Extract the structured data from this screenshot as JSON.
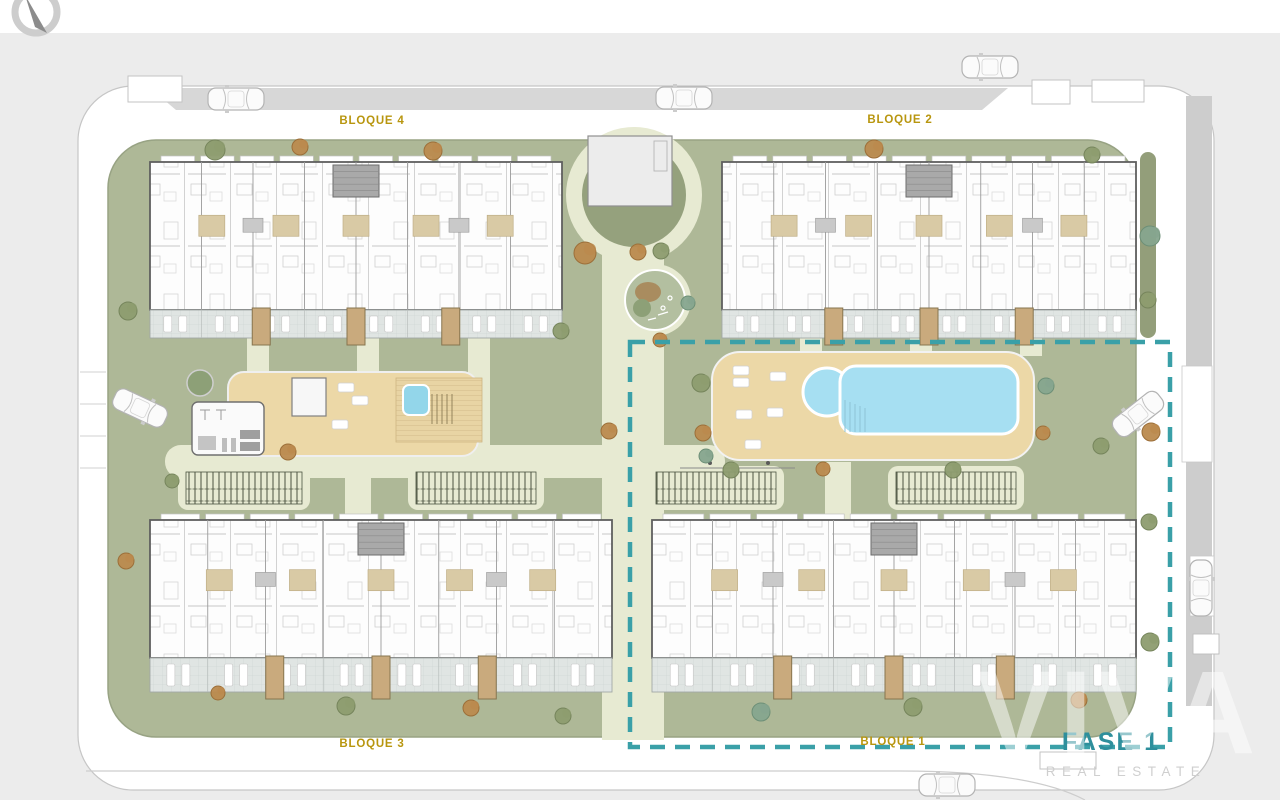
{
  "plan": {
    "title": "Residential complex site plan",
    "labels": {
      "bloque1": "BLOQUE 1",
      "bloque2": "BLOQUE 2",
      "bloque3": "BLOQUE 3",
      "bloque4": "BLOQUE 4"
    },
    "phase": {
      "label": "FASE 1",
      "style": "teal dashed boundary",
      "encloses": "bloque-1 and pool area"
    },
    "blocks": [
      {
        "id": "bloque-4",
        "position": "top-left"
      },
      {
        "id": "bloque-2",
        "position": "top-right"
      },
      {
        "id": "bloque-3",
        "position": "bottom-left"
      },
      {
        "id": "bloque-1",
        "position": "bottom-right"
      }
    ],
    "amenities": [
      "swimming pool",
      "children's round pool",
      "pool sun deck",
      "gym",
      "jacuzzi deck",
      "pool house",
      "playground",
      "community garden plots",
      "utility building",
      "perimeter parking"
    ],
    "watermark": {
      "brand": "VIVA",
      "tagline": "REAL ESTATE"
    },
    "icons": {
      "compass-icon": "north indicator ring with needle",
      "car-icon": "parked car top view",
      "tree-icon": "tree canopy blob",
      "lounger-icon": "sun lounger"
    },
    "colors": {
      "background": "#ececec",
      "road": "#ffffff",
      "sidewalk": "#d7d7d7",
      "grass": "#aeb897",
      "path": "#e7ead2",
      "deck": "#ecd8a7",
      "pool_water": "#a6dff2",
      "terrace": "#dfe4e2",
      "building_wall": "#5f5f5f",
      "phase_dash": "#3aa0a8",
      "phase_text": "#2e8f9c",
      "block_label": "#b8960f"
    }
  }
}
